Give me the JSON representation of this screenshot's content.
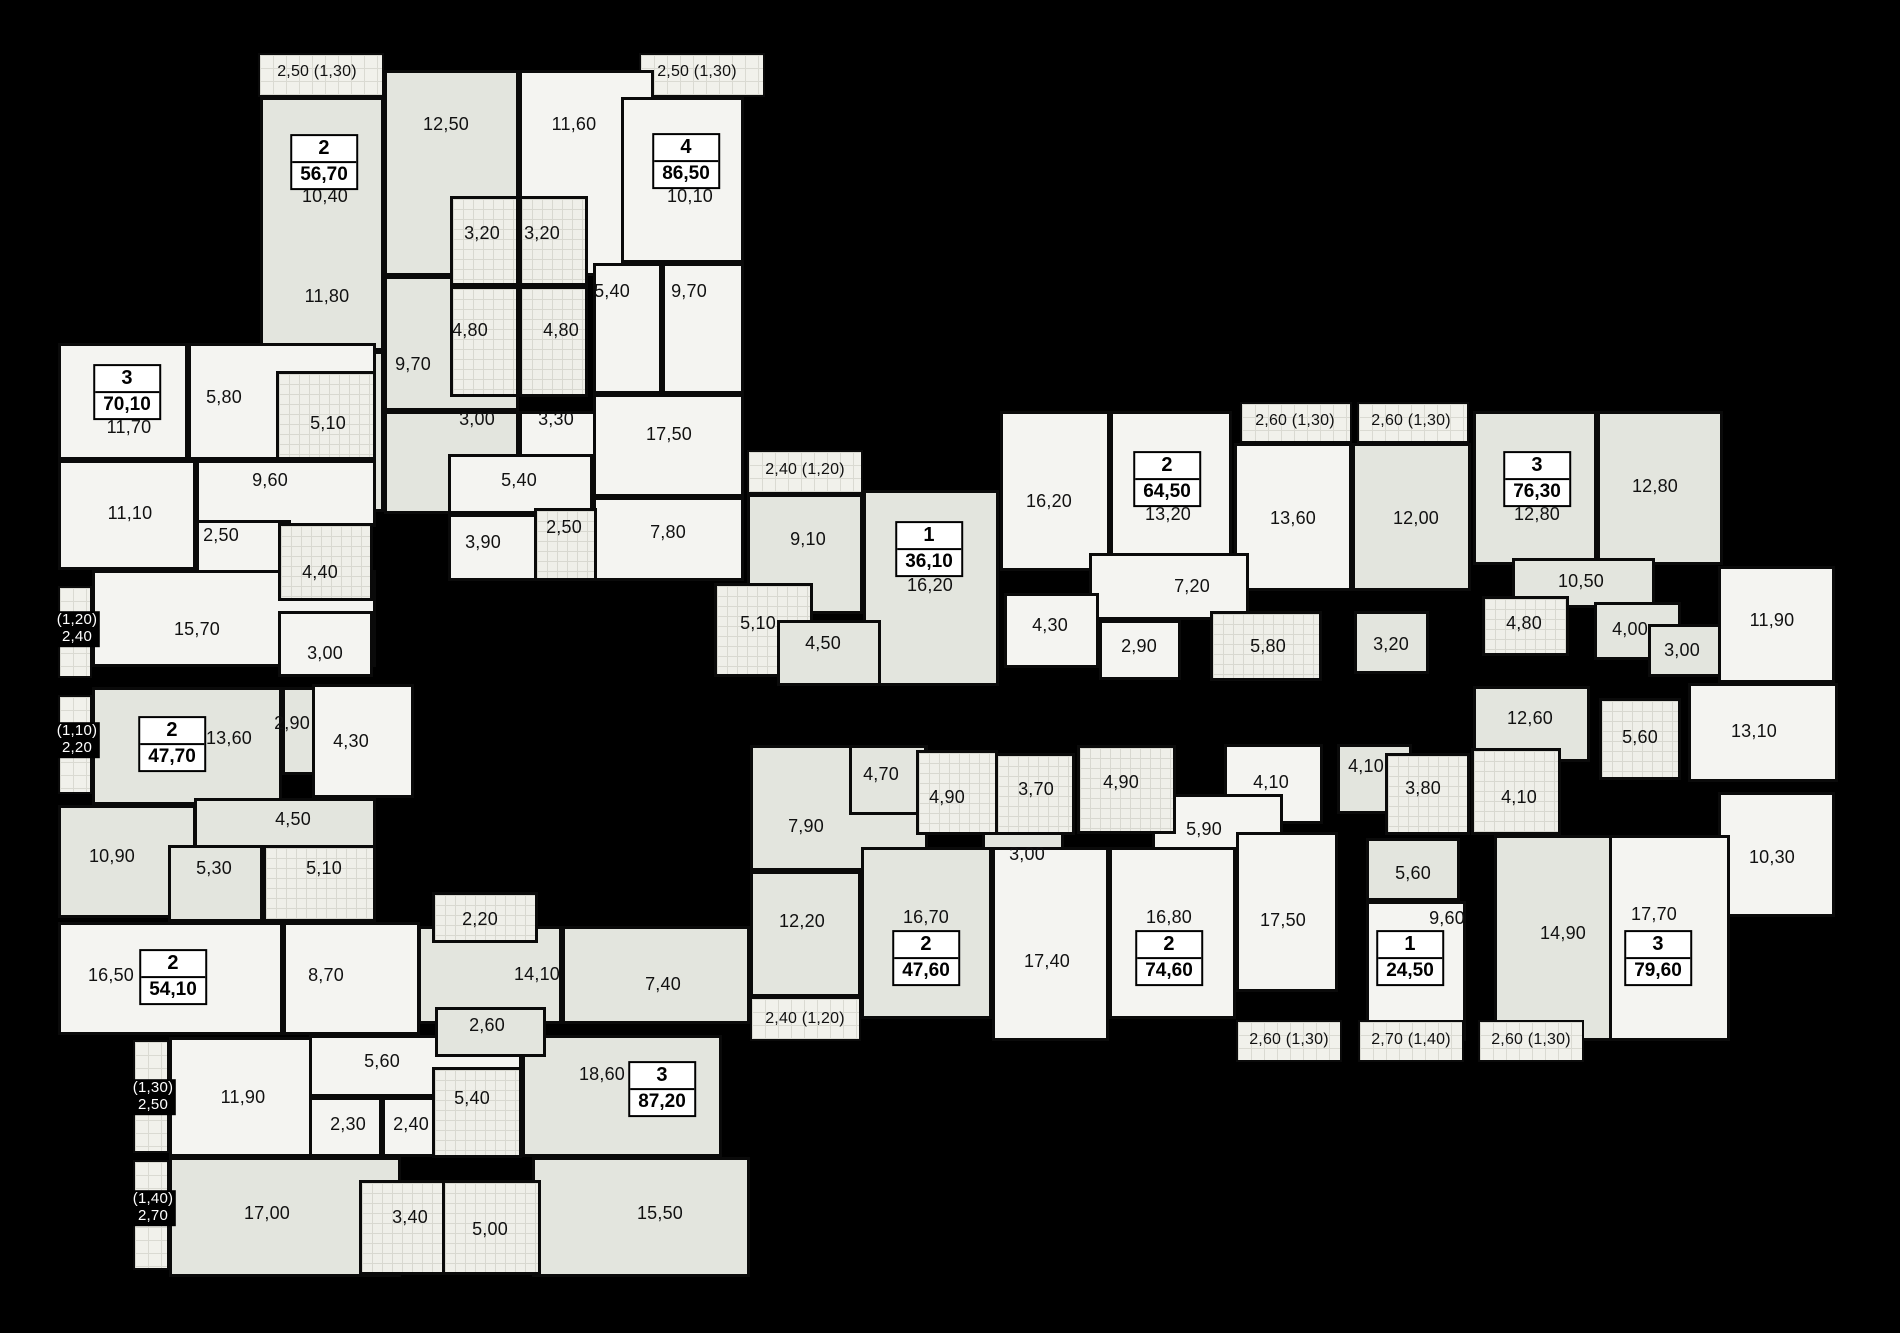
{
  "meta": {
    "description": "Residential building floor plan — apartments with room areas in m²"
  },
  "colors": {
    "background": "#000000",
    "wall": "#0a0a0a",
    "room_tint_dark": "#e3e5de",
    "room_tint_light": "#f4f4f1",
    "bathroom_tile": "#efefe9",
    "balcony_hatch": "#f1f1eb",
    "label": "#111111",
    "label_on_black": "#ffffff",
    "badge_background": "#ffffff"
  },
  "apartments": [
    {
      "rooms": "2",
      "area": "56,70",
      "x": 324,
      "y": 162
    },
    {
      "rooms": "4",
      "area": "86,50",
      "x": 686,
      "y": 161
    },
    {
      "rooms": "3",
      "area": "70,10",
      "x": 127,
      "y": 392
    },
    {
      "rooms": "1",
      "area": "36,10",
      "x": 929,
      "y": 549
    },
    {
      "rooms": "2",
      "area": "64,50",
      "x": 1167,
      "y": 479
    },
    {
      "rooms": "3",
      "area": "76,30",
      "x": 1537,
      "y": 479
    },
    {
      "rooms": "2",
      "area": "47,70",
      "x": 172,
      "y": 744
    },
    {
      "rooms": "2",
      "area": "54,10",
      "x": 173,
      "y": 977
    },
    {
      "rooms": "3",
      "area": "87,20",
      "x": 662,
      "y": 1089
    },
    {
      "rooms": "2",
      "area": "47,60",
      "x": 926,
      "y": 958
    },
    {
      "rooms": "2",
      "area": "74,60",
      "x": 1169,
      "y": 958
    },
    {
      "rooms": "1",
      "area": "24,50",
      "x": 1410,
      "y": 958
    },
    {
      "rooms": "3",
      "area": "79,60",
      "x": 1658,
      "y": 958
    }
  ],
  "rooms": [
    {
      "x": 258,
      "y": 53,
      "w": 126,
      "h": 44,
      "k": "h"
    },
    {
      "x": 639,
      "y": 53,
      "w": 126,
      "h": 44,
      "k": "h"
    },
    {
      "x": 260,
      "y": 97,
      "w": 124,
      "h": 254,
      "k": "a"
    },
    {
      "x": 260,
      "y": 351,
      "w": 124,
      "h": 161,
      "k": "a"
    },
    {
      "x": 384,
      "y": 70,
      "w": 135,
      "h": 206,
      "k": "a"
    },
    {
      "x": 519,
      "y": 70,
      "w": 135,
      "h": 206,
      "k": "b"
    },
    {
      "x": 621,
      "y": 97,
      "w": 123,
      "h": 166,
      "k": "b"
    },
    {
      "x": 384,
      "y": 276,
      "w": 135,
      "h": 135,
      "k": "a"
    },
    {
      "x": 384,
      "y": 411,
      "w": 135,
      "h": 103,
      "k": "a"
    },
    {
      "x": 519,
      "y": 411,
      "w": 103,
      "h": 103,
      "k": "b"
    },
    {
      "x": 593,
      "y": 263,
      "w": 69,
      "h": 131,
      "k": "b"
    },
    {
      "x": 662,
      "y": 263,
      "w": 82,
      "h": 131,
      "k": "b"
    },
    {
      "x": 593,
      "y": 394,
      "w": 151,
      "h": 103,
      "k": "b"
    },
    {
      "x": 593,
      "y": 497,
      "w": 151,
      "h": 84,
      "k": "b"
    },
    {
      "x": 448,
      "y": 454,
      "w": 145,
      "h": 60,
      "k": "b"
    },
    {
      "x": 448,
      "y": 514,
      "w": 103,
      "h": 67,
      "k": "b"
    },
    {
      "x": 450,
      "y": 196,
      "w": 69,
      "h": 90,
      "k": "t"
    },
    {
      "x": 519,
      "y": 196,
      "w": 69,
      "h": 90,
      "k": "t"
    },
    {
      "x": 450,
      "y": 286,
      "w": 69,
      "h": 111,
      "k": "t"
    },
    {
      "x": 519,
      "y": 286,
      "w": 69,
      "h": 111,
      "k": "t"
    },
    {
      "x": 534,
      "y": 508,
      "w": 63,
      "h": 73,
      "k": "t"
    },
    {
      "x": 58,
      "y": 343,
      "w": 130,
      "h": 117,
      "k": "b"
    },
    {
      "x": 188,
      "y": 343,
      "w": 188,
      "h": 117,
      "k": "b"
    },
    {
      "x": 58,
      "y": 460,
      "w": 138,
      "h": 110,
      "k": "b"
    },
    {
      "x": 196,
      "y": 460,
      "w": 180,
      "h": 67,
      "k": "b"
    },
    {
      "x": 196,
      "y": 520,
      "w": 95,
      "h": 58,
      "k": "b"
    },
    {
      "x": 92,
      "y": 570,
      "w": 284,
      "h": 97,
      "k": "b"
    },
    {
      "x": 278,
      "y": 611,
      "w": 95,
      "h": 66,
      "k": "b"
    },
    {
      "x": 276,
      "y": 371,
      "w": 100,
      "h": 89,
      "k": "t"
    },
    {
      "x": 278,
      "y": 523,
      "w": 95,
      "h": 78,
      "k": "t"
    },
    {
      "x": 58,
      "y": 586,
      "w": 34,
      "h": 92,
      "k": "h"
    },
    {
      "x": 92,
      "y": 687,
      "w": 190,
      "h": 118,
      "k": "a"
    },
    {
      "x": 282,
      "y": 687,
      "w": 70,
      "h": 88,
      "k": "a"
    },
    {
      "x": 312,
      "y": 684,
      "w": 102,
      "h": 114,
      "k": "b"
    },
    {
      "x": 194,
      "y": 798,
      "w": 182,
      "h": 52,
      "k": "a"
    },
    {
      "x": 58,
      "y": 805,
      "w": 138,
      "h": 113,
      "k": "a"
    },
    {
      "x": 168,
      "y": 845,
      "w": 95,
      "h": 77,
      "k": "a"
    },
    {
      "x": 263,
      "y": 845,
      "w": 113,
      "h": 77,
      "k": "t"
    },
    {
      "x": 58,
      "y": 695,
      "w": 34,
      "h": 99,
      "k": "h"
    },
    {
      "x": 58,
      "y": 922,
      "w": 225,
      "h": 113,
      "k": "b"
    },
    {
      "x": 283,
      "y": 922,
      "w": 137,
      "h": 113,
      "k": "b"
    },
    {
      "x": 169,
      "y": 1037,
      "w": 148,
      "h": 120,
      "k": "b"
    },
    {
      "x": 309,
      "y": 1035,
      "w": 213,
      "h": 62,
      "k": "b"
    },
    {
      "x": 309,
      "y": 1097,
      "w": 73,
      "h": 60,
      "k": "b"
    },
    {
      "x": 382,
      "y": 1097,
      "w": 68,
      "h": 60,
      "k": "b"
    },
    {
      "x": 169,
      "y": 1157,
      "w": 232,
      "h": 120,
      "k": "a"
    },
    {
      "x": 532,
      "y": 1157,
      "w": 218,
      "h": 120,
      "k": "a"
    },
    {
      "x": 522,
      "y": 1035,
      "w": 200,
      "h": 122,
      "k": "a"
    },
    {
      "x": 418,
      "y": 926,
      "w": 144,
      "h": 98,
      "k": "a"
    },
    {
      "x": 562,
      "y": 926,
      "w": 188,
      "h": 98,
      "k": "a"
    },
    {
      "x": 435,
      "y": 1007,
      "w": 111,
      "h": 50,
      "k": "a"
    },
    {
      "x": 432,
      "y": 892,
      "w": 106,
      "h": 51,
      "k": "t"
    },
    {
      "x": 432,
      "y": 1067,
      "w": 90,
      "h": 91,
      "k": "t"
    },
    {
      "x": 359,
      "y": 1180,
      "w": 99,
      "h": 95,
      "k": "t"
    },
    {
      "x": 442,
      "y": 1180,
      "w": 99,
      "h": 95,
      "k": "t"
    },
    {
      "x": 133,
      "y": 1040,
      "w": 36,
      "h": 113,
      "k": "h"
    },
    {
      "x": 133,
      "y": 1160,
      "w": 36,
      "h": 110,
      "k": "h"
    },
    {
      "x": 747,
      "y": 450,
      "w": 116,
      "h": 44,
      "k": "h"
    },
    {
      "x": 747,
      "y": 494,
      "w": 116,
      "h": 120,
      "k": "a"
    },
    {
      "x": 863,
      "y": 490,
      "w": 136,
      "h": 196,
      "k": "a"
    },
    {
      "x": 714,
      "y": 583,
      "w": 99,
      "h": 94,
      "k": "t"
    },
    {
      "x": 777,
      "y": 620,
      "w": 104,
      "h": 66,
      "k": "a"
    },
    {
      "x": 1000,
      "y": 411,
      "w": 110,
      "h": 160,
      "k": "b"
    },
    {
      "x": 1110,
      "y": 411,
      "w": 122,
      "h": 160,
      "k": "b"
    },
    {
      "x": 1234,
      "y": 443,
      "w": 118,
      "h": 148,
      "k": "b"
    },
    {
      "x": 1352,
      "y": 443,
      "w": 119,
      "h": 148,
      "k": "a"
    },
    {
      "x": 1089,
      "y": 553,
      "w": 160,
      "h": 67,
      "k": "b"
    },
    {
      "x": 1004,
      "y": 593,
      "w": 95,
      "h": 75,
      "k": "b"
    },
    {
      "x": 1099,
      "y": 620,
      "w": 82,
      "h": 60,
      "k": "b"
    },
    {
      "x": 1354,
      "y": 611,
      "w": 75,
      "h": 63,
      "k": "a"
    },
    {
      "x": 1210,
      "y": 611,
      "w": 112,
      "h": 70,
      "k": "t"
    },
    {
      "x": 1240,
      "y": 402,
      "w": 112,
      "h": 41,
      "k": "h"
    },
    {
      "x": 1357,
      "y": 402,
      "w": 112,
      "h": 41,
      "k": "h"
    },
    {
      "x": 1473,
      "y": 411,
      "w": 124,
      "h": 154,
      "k": "a"
    },
    {
      "x": 1597,
      "y": 411,
      "w": 126,
      "h": 154,
      "k": "a"
    },
    {
      "x": 1512,
      "y": 558,
      "w": 143,
      "h": 50,
      "k": "a"
    },
    {
      "x": 1594,
      "y": 602,
      "w": 87,
      "h": 58,
      "k": "a"
    },
    {
      "x": 1648,
      "y": 624,
      "w": 78,
      "h": 53,
      "k": "a"
    },
    {
      "x": 1718,
      "y": 566,
      "w": 117,
      "h": 117,
      "k": "b"
    },
    {
      "x": 1473,
      "y": 686,
      "w": 117,
      "h": 76,
      "k": "a"
    },
    {
      "x": 1688,
      "y": 683,
      "w": 150,
      "h": 99,
      "k": "b"
    },
    {
      "x": 1718,
      "y": 792,
      "w": 117,
      "h": 125,
      "k": "b"
    },
    {
      "x": 1482,
      "y": 596,
      "w": 87,
      "h": 60,
      "k": "t"
    },
    {
      "x": 1599,
      "y": 698,
      "w": 82,
      "h": 82,
      "k": "t"
    },
    {
      "x": 750,
      "y": 745,
      "w": 178,
      "h": 126,
      "k": "a"
    },
    {
      "x": 849,
      "y": 745,
      "w": 78,
      "h": 70,
      "k": "a"
    },
    {
      "x": 982,
      "y": 825,
      "w": 82,
      "h": 58,
      "k": "a"
    },
    {
      "x": 1224,
      "y": 744,
      "w": 99,
      "h": 80,
      "k": "b"
    },
    {
      "x": 1152,
      "y": 794,
      "w": 131,
      "h": 75,
      "k": "b"
    },
    {
      "x": 750,
      "y": 871,
      "w": 111,
      "h": 126,
      "k": "a"
    },
    {
      "x": 861,
      "y": 847,
      "w": 131,
      "h": 172,
      "k": "a"
    },
    {
      "x": 992,
      "y": 847,
      "w": 117,
      "h": 194,
      "k": "b"
    },
    {
      "x": 1109,
      "y": 847,
      "w": 127,
      "h": 172,
      "k": "b"
    },
    {
      "x": 1236,
      "y": 832,
      "w": 102,
      "h": 160,
      "k": "b"
    },
    {
      "x": 1337,
      "y": 744,
      "w": 75,
      "h": 70,
      "k": "a"
    },
    {
      "x": 1366,
      "y": 838,
      "w": 94,
      "h": 63,
      "k": "a"
    },
    {
      "x": 1366,
      "y": 901,
      "w": 100,
      "h": 140,
      "k": "b"
    },
    {
      "x": 1494,
      "y": 835,
      "w": 131,
      "h": 206,
      "k": "a"
    },
    {
      "x": 1609,
      "y": 835,
      "w": 121,
      "h": 206,
      "k": "b"
    },
    {
      "x": 916,
      "y": 750,
      "w": 82,
      "h": 85,
      "k": "t"
    },
    {
      "x": 995,
      "y": 753,
      "w": 80,
      "h": 82,
      "k": "t"
    },
    {
      "x": 1077,
      "y": 745,
      "w": 99,
      "h": 89,
      "k": "t"
    },
    {
      "x": 1385,
      "y": 753,
      "w": 85,
      "h": 82,
      "k": "t"
    },
    {
      "x": 1471,
      "y": 748,
      "w": 90,
      "h": 87,
      "k": "t"
    },
    {
      "x": 750,
      "y": 997,
      "w": 111,
      "h": 44,
      "k": "h"
    },
    {
      "x": 1236,
      "y": 1020,
      "w": 106,
      "h": 42,
      "k": "h"
    },
    {
      "x": 1358,
      "y": 1020,
      "w": 106,
      "h": 42,
      "k": "h"
    },
    {
      "x": 1478,
      "y": 1020,
      "w": 106,
      "h": 42,
      "k": "h"
    }
  ],
  "labels": [
    {
      "t": "2,50 (1,30)",
      "x": 317,
      "y": 72,
      "s": 16
    },
    {
      "t": "2,50 (1,30)",
      "x": 697,
      "y": 72,
      "s": 16
    },
    {
      "t": "12,50",
      "x": 446,
      "y": 124
    },
    {
      "t": "11,60",
      "x": 574,
      "y": 124
    },
    {
      "t": "10,40",
      "x": 325,
      "y": 196
    },
    {
      "t": "10,10",
      "x": 690,
      "y": 196
    },
    {
      "t": "3,20",
      "x": 482,
      "y": 233
    },
    {
      "t": "3,20",
      "x": 542,
      "y": 233
    },
    {
      "t": "11,80",
      "x": 327,
      "y": 296
    },
    {
      "t": "5,40",
      "x": 612,
      "y": 291
    },
    {
      "t": "9,70",
      "x": 689,
      "y": 291
    },
    {
      "t": "4,80",
      "x": 470,
      "y": 330
    },
    {
      "t": "4,80",
      "x": 561,
      "y": 330
    },
    {
      "t": "9,70",
      "x": 413,
      "y": 364
    },
    {
      "t": "3,00",
      "x": 477,
      "y": 419
    },
    {
      "t": "3,30",
      "x": 556,
      "y": 419
    },
    {
      "t": "17,50",
      "x": 669,
      "y": 434
    },
    {
      "t": "5,40",
      "x": 519,
      "y": 480
    },
    {
      "t": "3,90",
      "x": 483,
      "y": 542
    },
    {
      "t": "2,50",
      "x": 564,
      "y": 527
    },
    {
      "t": "7,80",
      "x": 668,
      "y": 532
    },
    {
      "t": "5,80",
      "x": 224,
      "y": 397
    },
    {
      "t": "11,70",
      "x": 129,
      "y": 427
    },
    {
      "t": "5,10",
      "x": 328,
      "y": 423
    },
    {
      "t": "9,60",
      "x": 270,
      "y": 480
    },
    {
      "t": "11,10",
      "x": 130,
      "y": 513
    },
    {
      "t": "2,50",
      "x": 221,
      "y": 535
    },
    {
      "t": "4,40",
      "x": 320,
      "y": 572
    },
    {
      "t": "(1,20)\n2,40",
      "x": 77,
      "y": 629,
      "light": true,
      "s": 15
    },
    {
      "t": "15,70",
      "x": 197,
      "y": 629
    },
    {
      "t": "3,00",
      "x": 325,
      "y": 653
    },
    {
      "t": "(1,10)\n2,20",
      "x": 77,
      "y": 740,
      "light": true,
      "s": 15
    },
    {
      "t": "13,60",
      "x": 229,
      "y": 738
    },
    {
      "t": "2,90",
      "x": 292,
      "y": 723
    },
    {
      "t": "4,30",
      "x": 351,
      "y": 741
    },
    {
      "t": "4,50",
      "x": 293,
      "y": 819
    },
    {
      "t": "10,90",
      "x": 112,
      "y": 856
    },
    {
      "t": "5,30",
      "x": 214,
      "y": 868
    },
    {
      "t": "5,10",
      "x": 324,
      "y": 868
    },
    {
      "t": "16,50",
      "x": 111,
      "y": 975
    },
    {
      "t": "8,70",
      "x": 326,
      "y": 975
    },
    {
      "t": "(1,30)\n2,50",
      "x": 153,
      "y": 1097,
      "light": true,
      "s": 15
    },
    {
      "t": "11,90",
      "x": 243,
      "y": 1097
    },
    {
      "t": "5,60",
      "x": 382,
      "y": 1061
    },
    {
      "t": "2,30",
      "x": 348,
      "y": 1124
    },
    {
      "t": "2,40",
      "x": 411,
      "y": 1124
    },
    {
      "t": "2,20",
      "x": 480,
      "y": 919
    },
    {
      "t": "14,10",
      "x": 537,
      "y": 974
    },
    {
      "t": "7,40",
      "x": 663,
      "y": 984
    },
    {
      "t": "2,60",
      "x": 487,
      "y": 1025
    },
    {
      "t": "18,60",
      "x": 602,
      "y": 1074
    },
    {
      "t": "5,40",
      "x": 472,
      "y": 1098
    },
    {
      "t": "(1,40)\n2,70",
      "x": 153,
      "y": 1208,
      "light": true,
      "s": 15
    },
    {
      "t": "17,00",
      "x": 267,
      "y": 1213
    },
    {
      "t": "3,40",
      "x": 410,
      "y": 1217
    },
    {
      "t": "5,00",
      "x": 490,
      "y": 1229
    },
    {
      "t": "15,50",
      "x": 660,
      "y": 1213
    },
    {
      "t": "2,40 (1,20)",
      "x": 805,
      "y": 470,
      "s": 16
    },
    {
      "t": "9,10",
      "x": 808,
      "y": 539
    },
    {
      "t": "16,20",
      "x": 930,
      "y": 585
    },
    {
      "t": "5,10",
      "x": 758,
      "y": 623
    },
    {
      "t": "4,50",
      "x": 823,
      "y": 643
    },
    {
      "t": "16,20",
      "x": 1049,
      "y": 501
    },
    {
      "t": "13,20",
      "x": 1168,
      "y": 514
    },
    {
      "t": "2,60 (1,30)",
      "x": 1295,
      "y": 421,
      "s": 16
    },
    {
      "t": "2,60 (1,30)",
      "x": 1411,
      "y": 421,
      "s": 16
    },
    {
      "t": "13,60",
      "x": 1293,
      "y": 518
    },
    {
      "t": "12,00",
      "x": 1416,
      "y": 518
    },
    {
      "t": "7,20",
      "x": 1192,
      "y": 586
    },
    {
      "t": "4,30",
      "x": 1050,
      "y": 625
    },
    {
      "t": "2,90",
      "x": 1139,
      "y": 646
    },
    {
      "t": "5,80",
      "x": 1268,
      "y": 646
    },
    {
      "t": "3,20",
      "x": 1391,
      "y": 644
    },
    {
      "t": "12,80",
      "x": 1537,
      "y": 514
    },
    {
      "t": "12,80",
      "x": 1655,
      "y": 486
    },
    {
      "t": "10,50",
      "x": 1581,
      "y": 581
    },
    {
      "t": "4,80",
      "x": 1524,
      "y": 623
    },
    {
      "t": "4,00",
      "x": 1630,
      "y": 629
    },
    {
      "t": "3,00",
      "x": 1682,
      "y": 650
    },
    {
      "t": "11,90",
      "x": 1772,
      "y": 620
    },
    {
      "t": "12,60",
      "x": 1530,
      "y": 718
    },
    {
      "t": "5,60",
      "x": 1640,
      "y": 737
    },
    {
      "t": "13,10",
      "x": 1754,
      "y": 731
    },
    {
      "t": "10,30",
      "x": 1772,
      "y": 857
    },
    {
      "t": "4,70",
      "x": 881,
      "y": 774
    },
    {
      "t": "4,90",
      "x": 947,
      "y": 797
    },
    {
      "t": "3,70",
      "x": 1036,
      "y": 789
    },
    {
      "t": "4,90",
      "x": 1121,
      "y": 782
    },
    {
      "t": "4,10",
      "x": 1271,
      "y": 782
    },
    {
      "t": "7,90",
      "x": 806,
      "y": 826
    },
    {
      "t": "3,00",
      "x": 1027,
      "y": 854
    },
    {
      "t": "5,90",
      "x": 1204,
      "y": 829
    },
    {
      "t": "4,10",
      "x": 1366,
      "y": 766
    },
    {
      "t": "3,80",
      "x": 1423,
      "y": 788
    },
    {
      "t": "4,10",
      "x": 1519,
      "y": 797
    },
    {
      "t": "5,60",
      "x": 1413,
      "y": 873
    },
    {
      "t": "9,60",
      "x": 1447,
      "y": 918
    },
    {
      "t": "12,20",
      "x": 802,
      "y": 921
    },
    {
      "t": "16,70",
      "x": 926,
      "y": 917
    },
    {
      "t": "17,40",
      "x": 1047,
      "y": 961
    },
    {
      "t": "16,80",
      "x": 1169,
      "y": 917
    },
    {
      "t": "17,50",
      "x": 1283,
      "y": 920
    },
    {
      "t": "14,90",
      "x": 1563,
      "y": 933
    },
    {
      "t": "17,70",
      "x": 1654,
      "y": 914
    },
    {
      "t": "2,40 (1,20)",
      "x": 805,
      "y": 1019,
      "s": 16
    },
    {
      "t": "2,60 (1,30)",
      "x": 1289,
      "y": 1040,
      "s": 16
    },
    {
      "t": "2,70 (1,40)",
      "x": 1411,
      "y": 1040,
      "s": 16
    },
    {
      "t": "2,60 (1,30)",
      "x": 1531,
      "y": 1040,
      "s": 16
    }
  ]
}
